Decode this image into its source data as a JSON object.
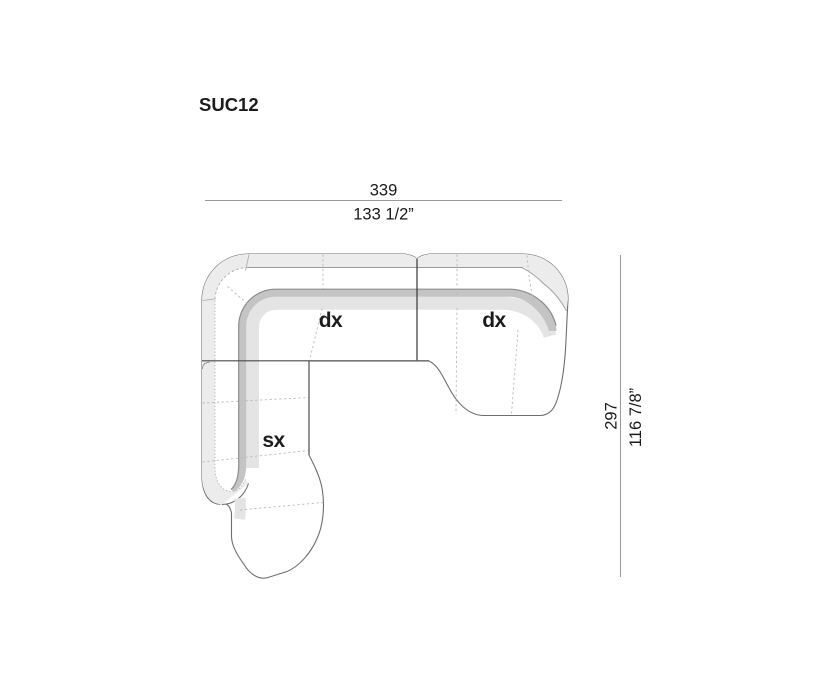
{
  "page": {
    "product_code": "SUC12"
  },
  "dimensions": {
    "width": {
      "cm": "339",
      "inches": "133 1/2”"
    },
    "depth": {
      "cm": "297",
      "inches": "116 7/8”"
    }
  },
  "sections": {
    "corner_label": "dx",
    "right_label": "dx",
    "left_label": "sx"
  },
  "colors": {
    "background": "#ffffff",
    "outline": "#6e6e6e",
    "shell_band": "#ececec",
    "back_band": "#c4c4c4",
    "band_edge": "#8c8c8c",
    "fade": "#e4e4e4",
    "divider": "#3c3c3c",
    "dim_line": "#9a9a9a",
    "text": "#1c1c1c"
  }
}
